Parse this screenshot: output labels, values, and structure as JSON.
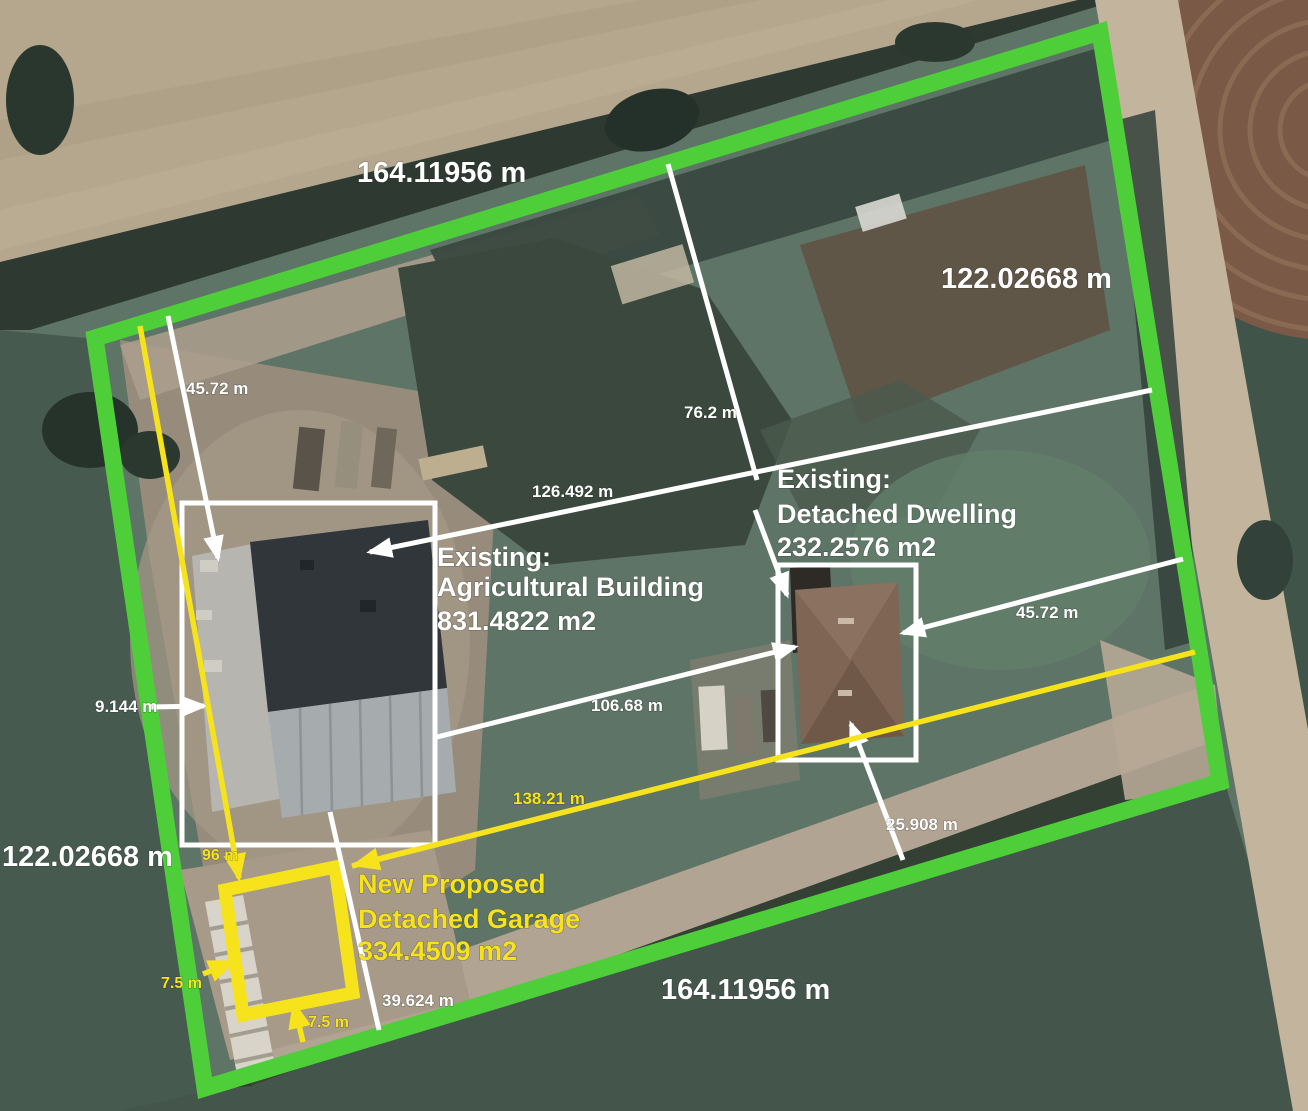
{
  "colors": {
    "boundary_green": "#4ecf3a",
    "proposed_yellow": "#f6e31c",
    "annotation_white": "#ffffff"
  },
  "boundary": {
    "top": "164.11956 m",
    "right": "122.02668 m",
    "bottom": "164.11956 m",
    "left": "122.02668 m"
  },
  "buildings": {
    "agricultural": {
      "line1": "Existing:",
      "line2": "Agricultural Building",
      "line3": "831.4822 m2"
    },
    "dwelling": {
      "line1": "Existing:",
      "line2": "Detached Dwelling",
      "line3": "232.2576 m2"
    },
    "garage": {
      "line1": "New Proposed",
      "line2": "Detached Garage",
      "line3": "334.4509 m2"
    }
  },
  "measurements": {
    "nw_setback": "45.72 m",
    "north_gate_depth": "76.2 m",
    "upper_width": "126.492 m",
    "east_setback": "45.72 m",
    "west_setback": "9.144 m",
    "mid_width": "106.68 m",
    "south_diagonal": "138.21 m",
    "west_depth": "96 m",
    "dwelling_rear_setback": "25.908 m",
    "garage_to_boundary": "39.624 m",
    "garage_side_setback": "7.5 m",
    "garage_rear_setback": "7.5 m"
  }
}
